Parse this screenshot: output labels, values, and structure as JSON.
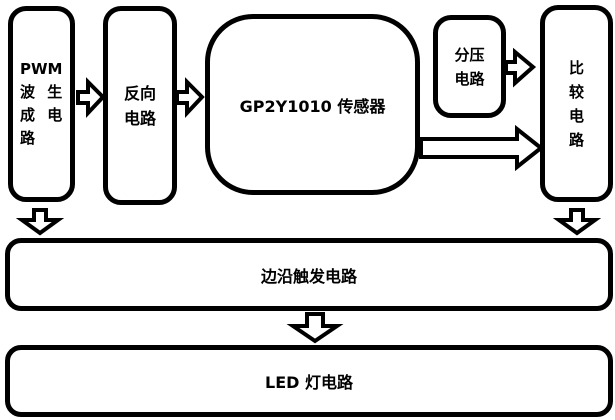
{
  "colors": {
    "background": "#ffffff",
    "line": "#000000",
    "box_fill": "#ffffff",
    "text": "#000000"
  },
  "boxes": {
    "pwm_generator": {
      "label": "PWM波生成电路",
      "lines": [
        "PWM",
        "波 生",
        "成 电",
        "路"
      ]
    },
    "inverter": {
      "label": "反向电路",
      "lines": [
        "反向",
        "电路"
      ]
    },
    "sensor": {
      "label": "GP2Y1010 传感器",
      "lines": [
        "GP2Y1010 传感器"
      ]
    },
    "voltage_divider": {
      "label": "分压电路",
      "lines": [
        "分压",
        "电路"
      ]
    },
    "comparator": {
      "label": "比较电路",
      "lines": [
        "比",
        "较",
        "电",
        "路"
      ]
    },
    "edge_trigger": {
      "label": "边沿触发电路",
      "lines": [
        "边沿触发电路"
      ]
    },
    "led": {
      "label": "LED 灯电路",
      "lines": [
        "LED 灯电路"
      ]
    }
  },
  "connections": [
    {
      "from": "pwm_generator",
      "to": "inverter",
      "direction": "right",
      "style": "hollow-arrow"
    },
    {
      "from": "inverter",
      "to": "sensor",
      "direction": "right",
      "style": "hollow-arrow"
    },
    {
      "from": "voltage_divider",
      "to": "comparator",
      "direction": "right",
      "style": "hollow-arrow"
    },
    {
      "from": "sensor",
      "to": "comparator",
      "direction": "right",
      "style": "hollow-arrow-long"
    },
    {
      "from": "pwm_generator",
      "to": "edge_trigger",
      "direction": "down",
      "style": "hollow-arrow"
    },
    {
      "from": "comparator",
      "to": "edge_trigger",
      "direction": "down",
      "style": "hollow-arrow"
    },
    {
      "from": "edge_trigger",
      "to": "led",
      "direction": "down",
      "style": "hollow-arrow"
    }
  ]
}
